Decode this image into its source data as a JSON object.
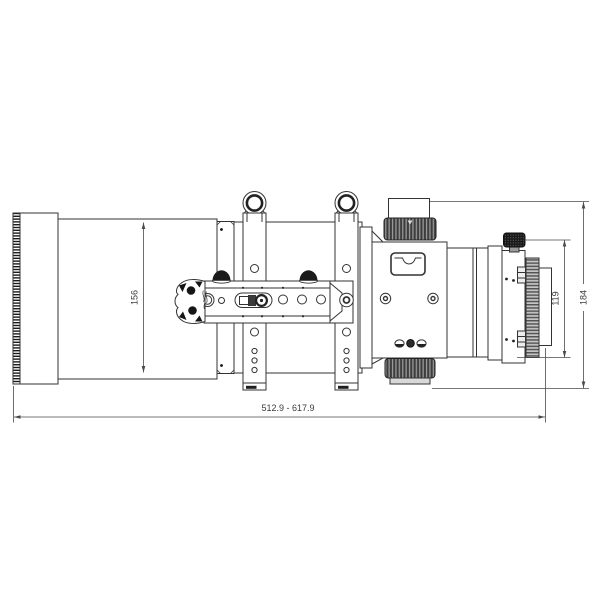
{
  "page": {
    "background": "#ffffff"
  },
  "drawing": {
    "subject": "Refractor telescope optical tube assembly — side elevation technical drawing",
    "line_color": "#333333",
    "dimension_color": "#4a4a4a"
  },
  "dimensions": {
    "tube_diameter": "156",
    "rear_assembly_height": "119",
    "overall_height": "184",
    "overall_length_range": "512.9 - 617.9"
  }
}
